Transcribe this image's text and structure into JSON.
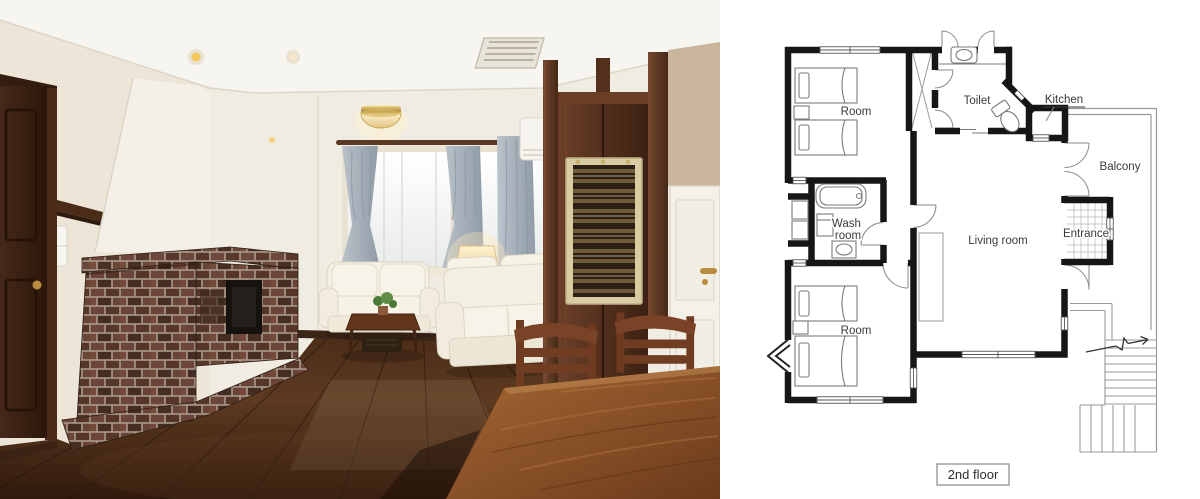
{
  "floor_plan": {
    "rooms": {
      "room_top": "Room",
      "toilet": "Toilet",
      "kitchen": "Kitchen",
      "balcony": "Balcony",
      "wash_room": {
        "line1": "Wash",
        "line2": "room"
      },
      "living_room": "Living room",
      "entrance": "Entrance",
      "room_bottom": "Room"
    },
    "caption": "2nd floor",
    "colors": {
      "background": "#ffffff",
      "wall": "#161616",
      "thin_line": "#9a9a9a",
      "text": "#3a3a3a"
    }
  },
  "photo": {
    "colors": {
      "wall": "#f1ece2",
      "ceiling": "#f7f5ef",
      "floor_dark": "#30190c",
      "brick": "#6b4539",
      "mortar": "#a8998a",
      "curtain": "#a3aeb8",
      "sofa": "#f3efe3",
      "wood_trim": "#4a2b18",
      "dining_table": "#8a4e28",
      "accent_brass": "#b98d3e"
    }
  }
}
